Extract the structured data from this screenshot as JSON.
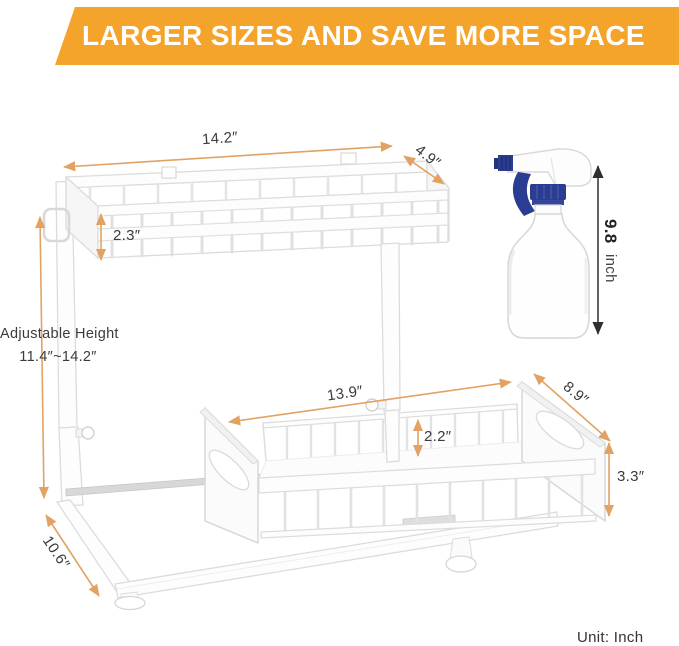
{
  "banner": {
    "text": "LARGER SIZES AND SAVE MORE SPACE",
    "bg_color": "#F5A42B",
    "text_color": "#FFFFFF"
  },
  "labels": {
    "top_width": "14.2″",
    "top_depth": "4.9″",
    "upper_basket_height": "2.3″",
    "adjustable_height_title": "Adjustable Height",
    "adjustable_height_range": "11.4″~14.2″",
    "lower_basket_width": "13.9″",
    "lower_rail_height": "2.2″",
    "lower_basket_depth": "8.9″",
    "lower_side_height": "3.3″",
    "base_depth": "10.6″",
    "bottle_height_value": "9.8",
    "bottle_height_unit": "inch",
    "unit_note": "Unit: Inch"
  },
  "colors": {
    "banner_orange": "#F5A42B",
    "dimension_line_orange": "#E2A263",
    "label_text": "#3B3B3B",
    "bottle_blue": "#2B3D93",
    "drawing_stroke": "#DCDCDC",
    "arrow_black": "#2F2F2F"
  }
}
